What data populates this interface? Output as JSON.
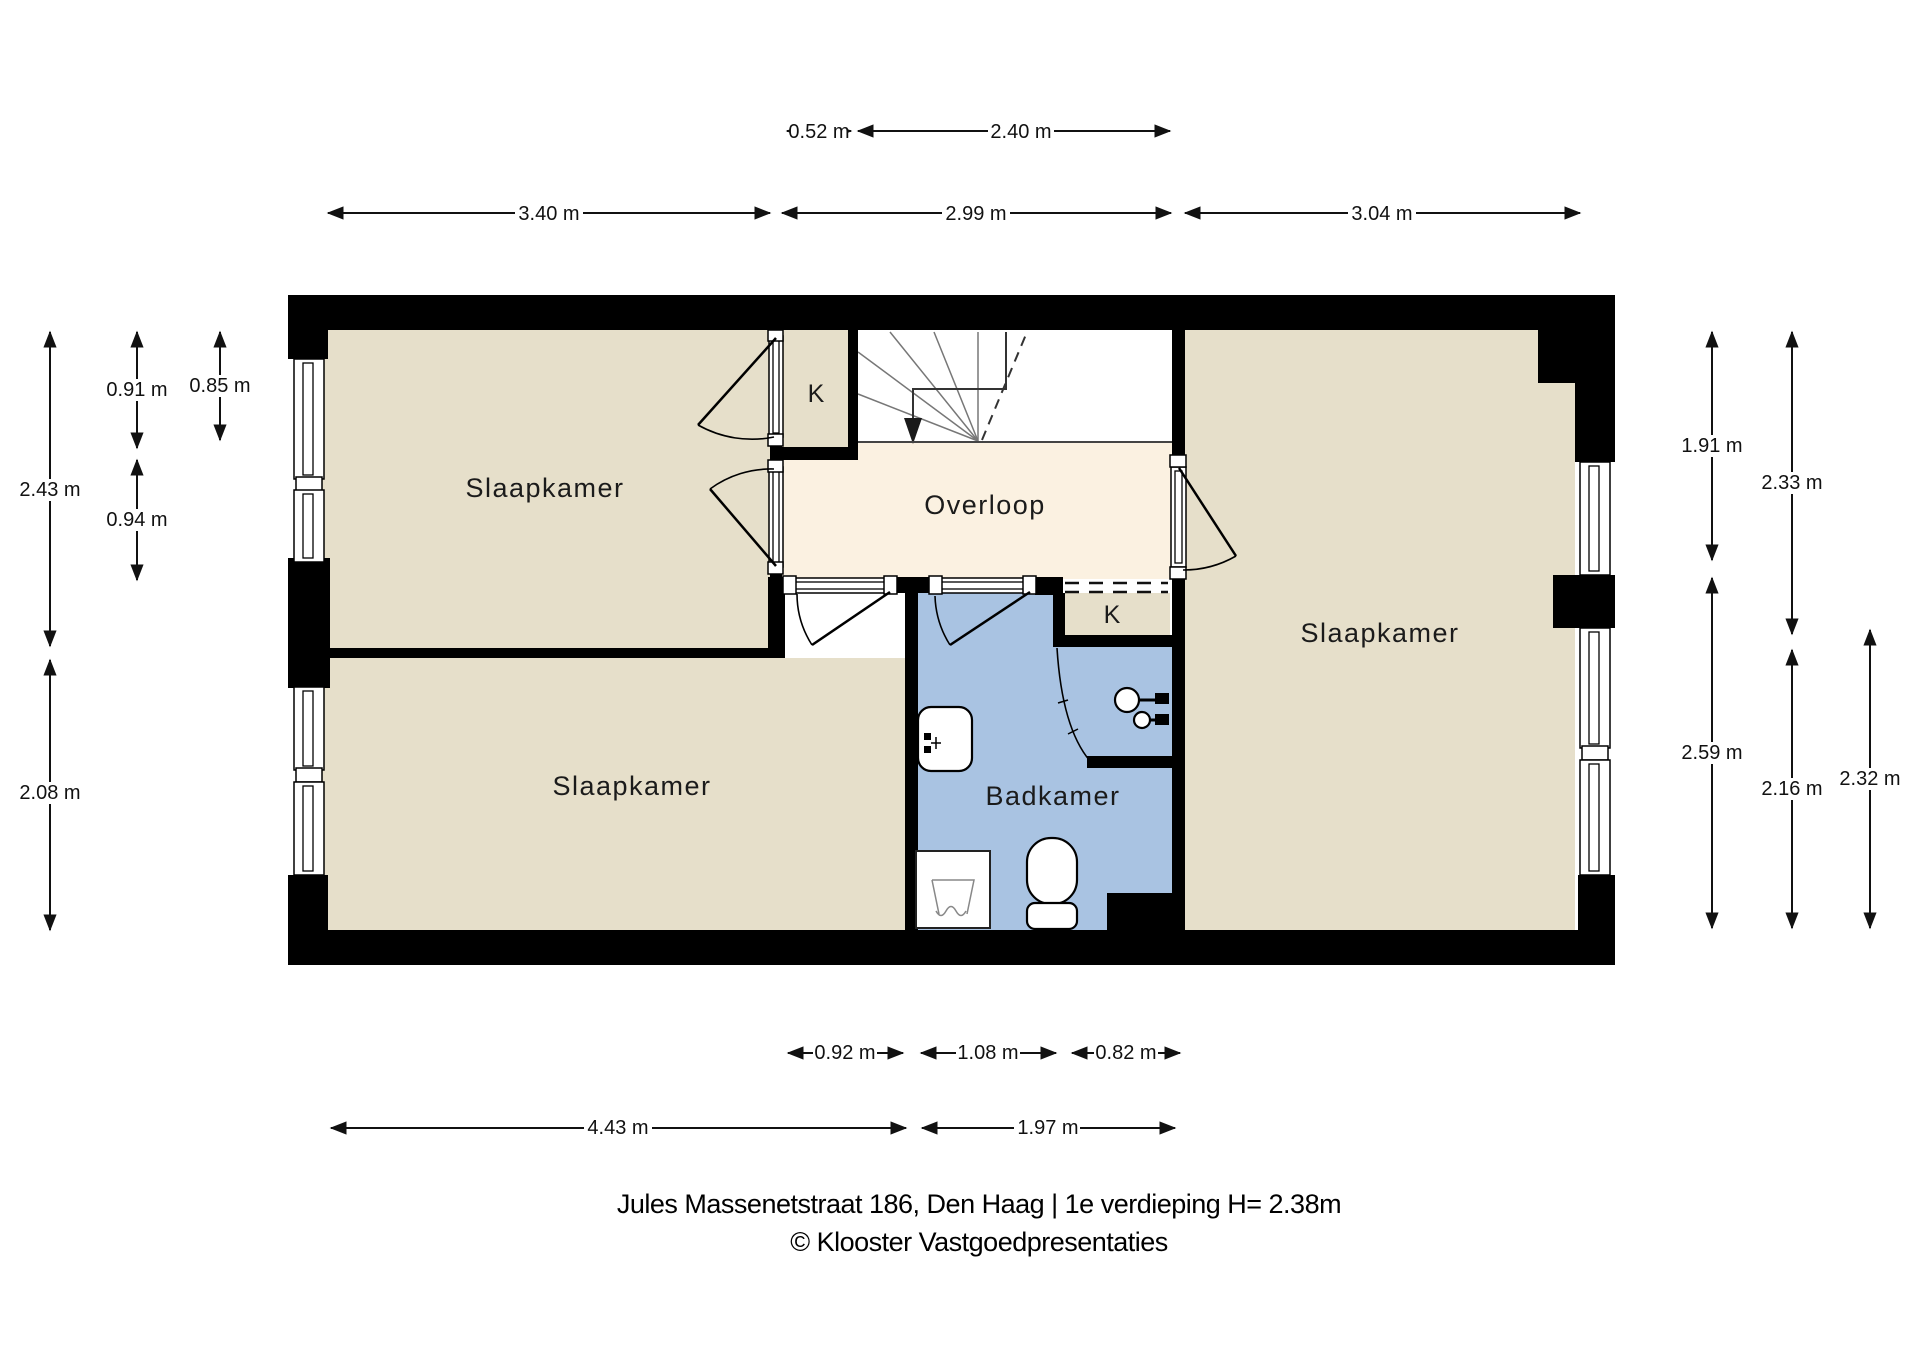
{
  "title": {
    "line1": "Jules Massenetstraat 186, Den Haag | 1e verdieping H= 2.38m",
    "line2": "© Klooster Vastgoedpresentaties"
  },
  "rooms": {
    "bedroom_top_left": "Slaapkamer",
    "bedroom_bottom_left": "Slaapkamer",
    "bedroom_right": "Slaapkamer",
    "landing": "Overloop",
    "bathroom": "Badkamer",
    "closet_top": "K",
    "closet_bathroom": "K"
  },
  "dimensions": {
    "top_inner": [
      "0.52 m",
      "2.40 m"
    ],
    "top_outer": [
      "3.40 m",
      "2.99 m",
      "3.04 m"
    ],
    "left": [
      "2.43 m",
      "0.91 m",
      "0.85 m",
      "0.94 m",
      "2.08 m"
    ],
    "right": [
      "1.91 m",
      "2.33 m",
      "2.59 m",
      "2.16 m",
      "2.32 m"
    ],
    "bottom_inner": [
      "0.92 m",
      "1.08 m",
      "0.82 m"
    ],
    "bottom_outer": [
      "4.43 m",
      "1.97 m"
    ]
  },
  "colors": {
    "wall": "#000000",
    "room": "#e6dfca",
    "hall": "#fbf1e1",
    "bath": "#a9c3e2",
    "white": "#ffffff"
  }
}
